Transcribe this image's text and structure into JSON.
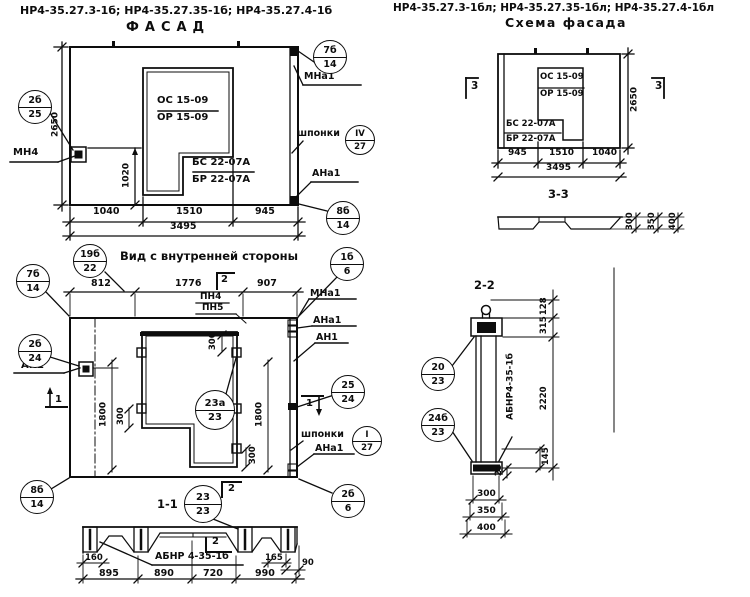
{
  "header": {
    "codes_left": "НР4-35.27.3-1б; НР4-35.27.35-1б; НР4-35.27.4-1б",
    "title_left": "ФАСАД",
    "codes_right": "НР4-35.27.3-1бл; НР4-35.27.35-1бл; НР4-35.27.4-1бл",
    "title_right": "Схема фасада"
  },
  "facade": {
    "window_mark_top": "ОС 15-09",
    "window_mark_bottom": "ОР 15-09",
    "sill_mark_top": "БС 22-07А",
    "sill_mark_bottom": "БР 22-07А",
    "label_mn4": "МН4",
    "label_mna1": "МНа1",
    "label_shponki": "шпонки",
    "label_ana1": "АНа1",
    "dims": {
      "w1": "1040",
      "w2": "1510",
      "w3": "945",
      "total": "3495",
      "height": "2650",
      "anchor": "1020"
    },
    "callouts": {
      "c7b14": {
        "top": "7б",
        "bot": "14"
      },
      "c2b25": {
        "top": "2б",
        "bot": "25"
      },
      "civ27": {
        "top": "IV",
        "bot": "27"
      },
      "c8b14": {
        "top": "8б",
        "bot": "14"
      }
    }
  },
  "inner": {
    "title": "Вид с внутренней стороны",
    "dims": {
      "w1": "812",
      "w2": "1776",
      "w3": "907",
      "h_left": "1800",
      "h_right": "1800",
      "s1": "300",
      "s2": "300",
      "s3": "300"
    },
    "labels": {
      "pn4": "ПН4",
      "pn5": "ПН5",
      "mna1": "МНа1",
      "ana1": "АНа1",
      "an1": "АН1",
      "an2": "АН2",
      "ana1b": "АНа1",
      "shponki": "шпонки"
    },
    "sections": {
      "s1": "1",
      "s2": "2"
    },
    "callouts": {
      "c19b22": {
        "top": "19б",
        "bot": "22"
      },
      "c1b6": {
        "top": "1б",
        "bot": "6"
      },
      "c7b14": {
        "top": "7б",
        "bot": "14"
      },
      "c2b24": {
        "top": "2б",
        "bot": "24"
      },
      "c25_24": {
        "top": "25",
        "bot": "24"
      },
      "ci27": {
        "top": "I",
        "bot": "27"
      },
      "c2b6": {
        "top": "2б",
        "bot": "6"
      },
      "c8b14": {
        "top": "8б",
        "bot": "14"
      },
      "c23a23": {
        "top": "23а",
        "bot": "23"
      }
    }
  },
  "sec11": {
    "title": "1-1",
    "marker": "2",
    "label": "АБНР 4-35-1б",
    "callout": {
      "top": "23",
      "bot": "23"
    },
    "dims": {
      "d160": "160",
      "d165": "165",
      "d90": "90",
      "d895": "895",
      "d890": "890",
      "d720": "720",
      "d990": "990"
    }
  },
  "schema": {
    "window_mark_top": "ОС 15-09",
    "window_mark_bottom": "ОР 15-09",
    "sill_mark_top": "БС 22-07А",
    "sill_mark_bottom": "БР 22-07А",
    "section": "3",
    "dims": {
      "w1": "945",
      "w2": "1510",
      "w3": "1040",
      "total": "3495",
      "height": "2650"
    },
    "sec33": {
      "title": "3-3",
      "d300": "300",
      "d350": "350",
      "d400": "400"
    }
  },
  "sec22": {
    "title": "2-2",
    "label": "АБНР4-35-1б",
    "dims": {
      "d128": "128",
      "d315": "315",
      "d2220": "2220",
      "d145": "145",
      "d25": "25",
      "d300": "300",
      "d350": "350",
      "d400": "400"
    },
    "callouts": {
      "c20_23": {
        "top": "20",
        "bot": "23"
      },
      "c24b23": {
        "top": "24б",
        "bot": "23"
      }
    }
  }
}
